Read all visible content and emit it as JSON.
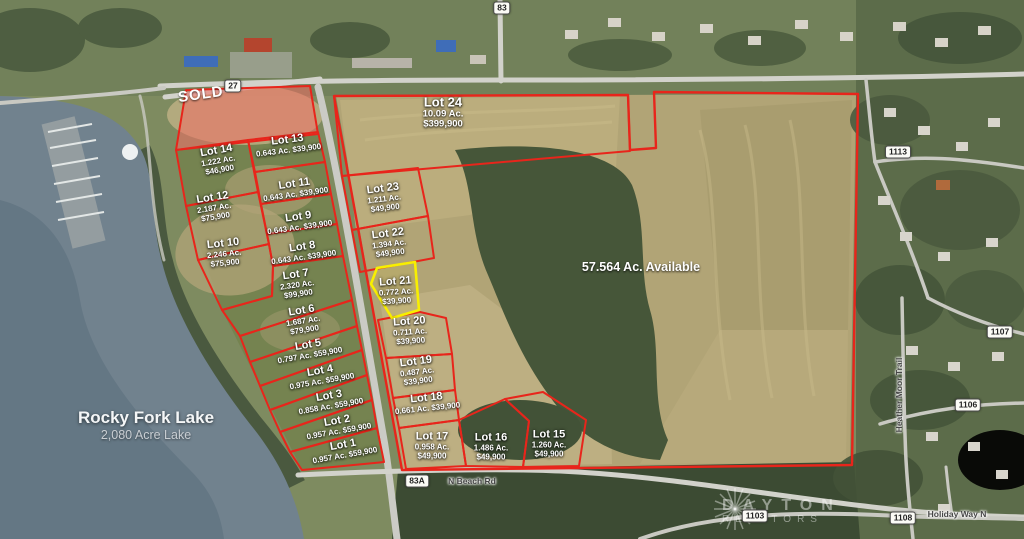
{
  "map": {
    "sold_label": "SOLD",
    "available_label": "57.564 Ac. Available",
    "lake_label": {
      "name": "Rocky Fork Lake",
      "subtitle": "2,080 Acre Lake"
    },
    "watermark": {
      "line1": "DAYTON",
      "line2": "REALTORS"
    },
    "colors": {
      "lot_line": "#e8251b",
      "highlight_line": "#f8ef00",
      "sold_fill": "rgba(243,110,100,0.55)"
    },
    "road_badges": [
      {
        "label": "83",
        "x": 502,
        "y": 8
      },
      {
        "label": "27",
        "x": 233,
        "y": 86
      },
      {
        "label": "83A",
        "x": 417,
        "y": 481
      },
      {
        "label": "1103",
        "x": 755,
        "y": 516
      },
      {
        "label": "1108",
        "x": 903,
        "y": 518
      },
      {
        "label": "1113",
        "x": 898,
        "y": 152
      },
      {
        "label": "1107",
        "x": 1000,
        "y": 332
      },
      {
        "label": "1106",
        "x": 968,
        "y": 405
      }
    ],
    "road_names": [
      {
        "label": "N Beach Rd",
        "x": 472,
        "y": 481,
        "angle": 0
      },
      {
        "label": "Holiday Way N",
        "x": 957,
        "y": 514,
        "angle": 0
      },
      {
        "label": "Heather Moor Trail",
        "x": 899,
        "y": 395,
        "angle": -90
      }
    ],
    "lots": [
      {
        "label": "Lot 1",
        "acres": "0.957 Ac.",
        "price": "$59,900",
        "inline": true,
        "x": 344,
        "y": 450,
        "angle": -10
      },
      {
        "label": "Lot 2",
        "acres": "0.957 Ac.",
        "price": "$59,900",
        "inline": true,
        "x": 338,
        "y": 426,
        "angle": -10
      },
      {
        "label": "Lot 3",
        "acres": "0.858 Ac.",
        "price": "$59,900",
        "inline": true,
        "x": 330,
        "y": 401,
        "angle": -10
      },
      {
        "label": "Lot 4",
        "acres": "0.975 Ac.",
        "price": "$59,900",
        "inline": true,
        "x": 321,
        "y": 376,
        "angle": -10
      },
      {
        "label": "Lot 5",
        "acres": "0.797 Ac.",
        "price": "$59,900",
        "inline": true,
        "x": 309,
        "y": 350,
        "angle": -10
      },
      {
        "label": "Lot 6",
        "acres": "1.687 Ac.",
        "price": "$79,900",
        "inline": false,
        "x": 303,
        "y": 320,
        "angle": -9
      },
      {
        "label": "Lot 7",
        "acres": "2.320 Ac.",
        "price": "$99,900",
        "inline": false,
        "x": 297,
        "y": 284,
        "angle": -8
      },
      {
        "label": "Lot 8",
        "acres": "0.643 Ac.",
        "price": "$39,900",
        "inline": true,
        "x": 303,
        "y": 252,
        "angle": -8
      },
      {
        "label": "Lot 9",
        "acres": "0.643 Ac.",
        "price": "$39,900",
        "inline": true,
        "x": 299,
        "y": 222,
        "angle": -8
      },
      {
        "label": "Lot 10",
        "acres": "2.246 Ac.",
        "price": "$75,900",
        "inline": false,
        "x": 224,
        "y": 253,
        "angle": -6
      },
      {
        "label": "Lot 11",
        "acres": "0.643 Ac.",
        "price": "$39,900",
        "inline": true,
        "x": 295,
        "y": 189,
        "angle": -8
      },
      {
        "label": "Lot 12",
        "acres": "2.187 Ac.",
        "price": "$75,900",
        "inline": false,
        "x": 214,
        "y": 207,
        "angle": -9
      },
      {
        "label": "Lot 13",
        "acres": "0.643 Ac.",
        "price": "$39,900",
        "inline": true,
        "x": 288,
        "y": 145,
        "angle": -7
      },
      {
        "label": "Lot 14",
        "acres": "1.222 Ac.",
        "price": "$46,900",
        "inline": false,
        "x": 218,
        "y": 160,
        "angle": -10
      },
      {
        "label": "Lot 15",
        "acres": "1.260 Ac.",
        "price": "$49,900",
        "inline": false,
        "x": 549,
        "y": 444,
        "angle": 0
      },
      {
        "label": "Lot 16",
        "acres": "1.486 Ac.",
        "price": "$49,900",
        "inline": false,
        "x": 491,
        "y": 447,
        "angle": 0
      },
      {
        "label": "Lot 17",
        "acres": "0.958 Ac.",
        "price": "$49,900",
        "inline": false,
        "x": 432,
        "y": 446,
        "angle": 0
      },
      {
        "label": "Lot 18",
        "acres": "0.661 Ac.",
        "price": "$39,900",
        "inline": true,
        "x": 427,
        "y": 403,
        "angle": -6
      },
      {
        "label": "Lot 19",
        "acres": "0.487 Ac.",
        "price": "$39,900",
        "inline": false,
        "x": 417,
        "y": 371,
        "angle": -7
      },
      {
        "label": "Lot 20",
        "acres": "0.711 Ac.",
        "price": "$39,900",
        "inline": false,
        "x": 410,
        "y": 331,
        "angle": -4
      },
      {
        "label": "Lot 21",
        "acres": "0.772 Ac.",
        "price": "$39,900",
        "inline": false,
        "x": 396,
        "y": 291,
        "angle": -4
      },
      {
        "label": "Lot 22",
        "acres": "1.394 Ac.",
        "price": "$49,900",
        "inline": false,
        "x": 389,
        "y": 243,
        "angle": -7
      },
      {
        "label": "Lot 23",
        "acres": "1.211 Ac.",
        "price": "$49,900",
        "inline": false,
        "x": 384,
        "y": 198,
        "angle": -7
      },
      {
        "label": "Lot 24",
        "acres": "10.09 Ac.",
        "price": "$399,900",
        "inline": false,
        "x": 443,
        "y": 113,
        "angle": 0,
        "big": true
      }
    ],
    "parcels": [
      {
        "name": "parcel-sold",
        "kind": "sold",
        "points": "186,90 310,86 318,134 176,150"
      },
      {
        "name": "parcel-lot-14",
        "kind": "lot",
        "points": "176,150 248,140 258,192 186,206"
      },
      {
        "name": "parcel-lot-13",
        "kind": "lot",
        "points": "248,140 318,132 325,162 255,172"
      },
      {
        "name": "parcel-lot-12",
        "kind": "lot",
        "points": "186,206 258,192 269,244 198,260"
      },
      {
        "name": "parcel-lot-11",
        "kind": "lot",
        "points": "255,172 325,162 331,194 261,204"
      },
      {
        "name": "parcel-lot-10",
        "kind": "lot",
        "points": "198,260 269,244 273,266 272,296 222,310"
      },
      {
        "name": "parcel-lot-9",
        "kind": "lot",
        "points": "261,204 331,194 337,224 267,234"
      },
      {
        "name": "parcel-lot-8",
        "kind": "lot",
        "points": "267,234 337,224 343,256 273,266"
      },
      {
        "name": "parcel-lot-7",
        "kind": "lot",
        "points": "222,310 272,296 273,266 343,256 352,300 240,336"
      },
      {
        "name": "parcel-lot-6",
        "kind": "lot",
        "points": "240,336 352,300 357,326 250,362"
      },
      {
        "name": "parcel-lot-5",
        "kind": "lot",
        "points": "250,362 357,326 362,350 260,386"
      },
      {
        "name": "parcel-lot-4",
        "kind": "lot",
        "points": "260,386 362,350 367,375 270,410"
      },
      {
        "name": "parcel-lot-3",
        "kind": "lot",
        "points": "270,410 367,375 372,400 280,432"
      },
      {
        "name": "parcel-lot-2",
        "kind": "lot",
        "points": "280,432 372,400 377,428 290,452"
      },
      {
        "name": "parcel-lot-1",
        "kind": "lot",
        "points": "290,452 377,428 384,462 302,470"
      },
      {
        "name": "parcel-available-boundary",
        "kind": "lot outer",
        "points": "334,96 628,95 630,150 656,148 654,92 858,94 852,465 402,470"
      },
      {
        "name": "parcel-lot-24",
        "kind": "lot",
        "points": "334,96 628,95 630,151 342,176"
      },
      {
        "name": "parcel-lot-23",
        "kind": "lot",
        "points": "342,176 418,168 428,216 352,230"
      },
      {
        "name": "parcel-lot-22",
        "kind": "lot",
        "points": "352,230 428,216 434,258 360,272"
      },
      {
        "name": "parcel-lot-20",
        "kind": "lot",
        "points": "378,320 420,312 446,318 452,354 386,358"
      },
      {
        "name": "parcel-lot-19",
        "kind": "lot",
        "points": "386,358 452,354 455,390 393,398"
      },
      {
        "name": "parcel-lot-18",
        "kind": "lot",
        "points": "393,398 455,390 459,420 399,428"
      },
      {
        "name": "parcel-lot-17",
        "kind": "lot",
        "points": "399,428 459,420 466,466 406,469"
      },
      {
        "name": "parcel-lot-16",
        "kind": "lot",
        "points": "459,420 505,399 529,421 523,467 466,466"
      },
      {
        "name": "parcel-lot-15",
        "kind": "lot",
        "points": "505,399 543,392 586,420 579,466 523,467 529,421"
      },
      {
        "name": "parcel-lot-21",
        "kind": "highlight",
        "points": "377,268 415,262 419,310 392,318 371,284"
      }
    ]
  }
}
